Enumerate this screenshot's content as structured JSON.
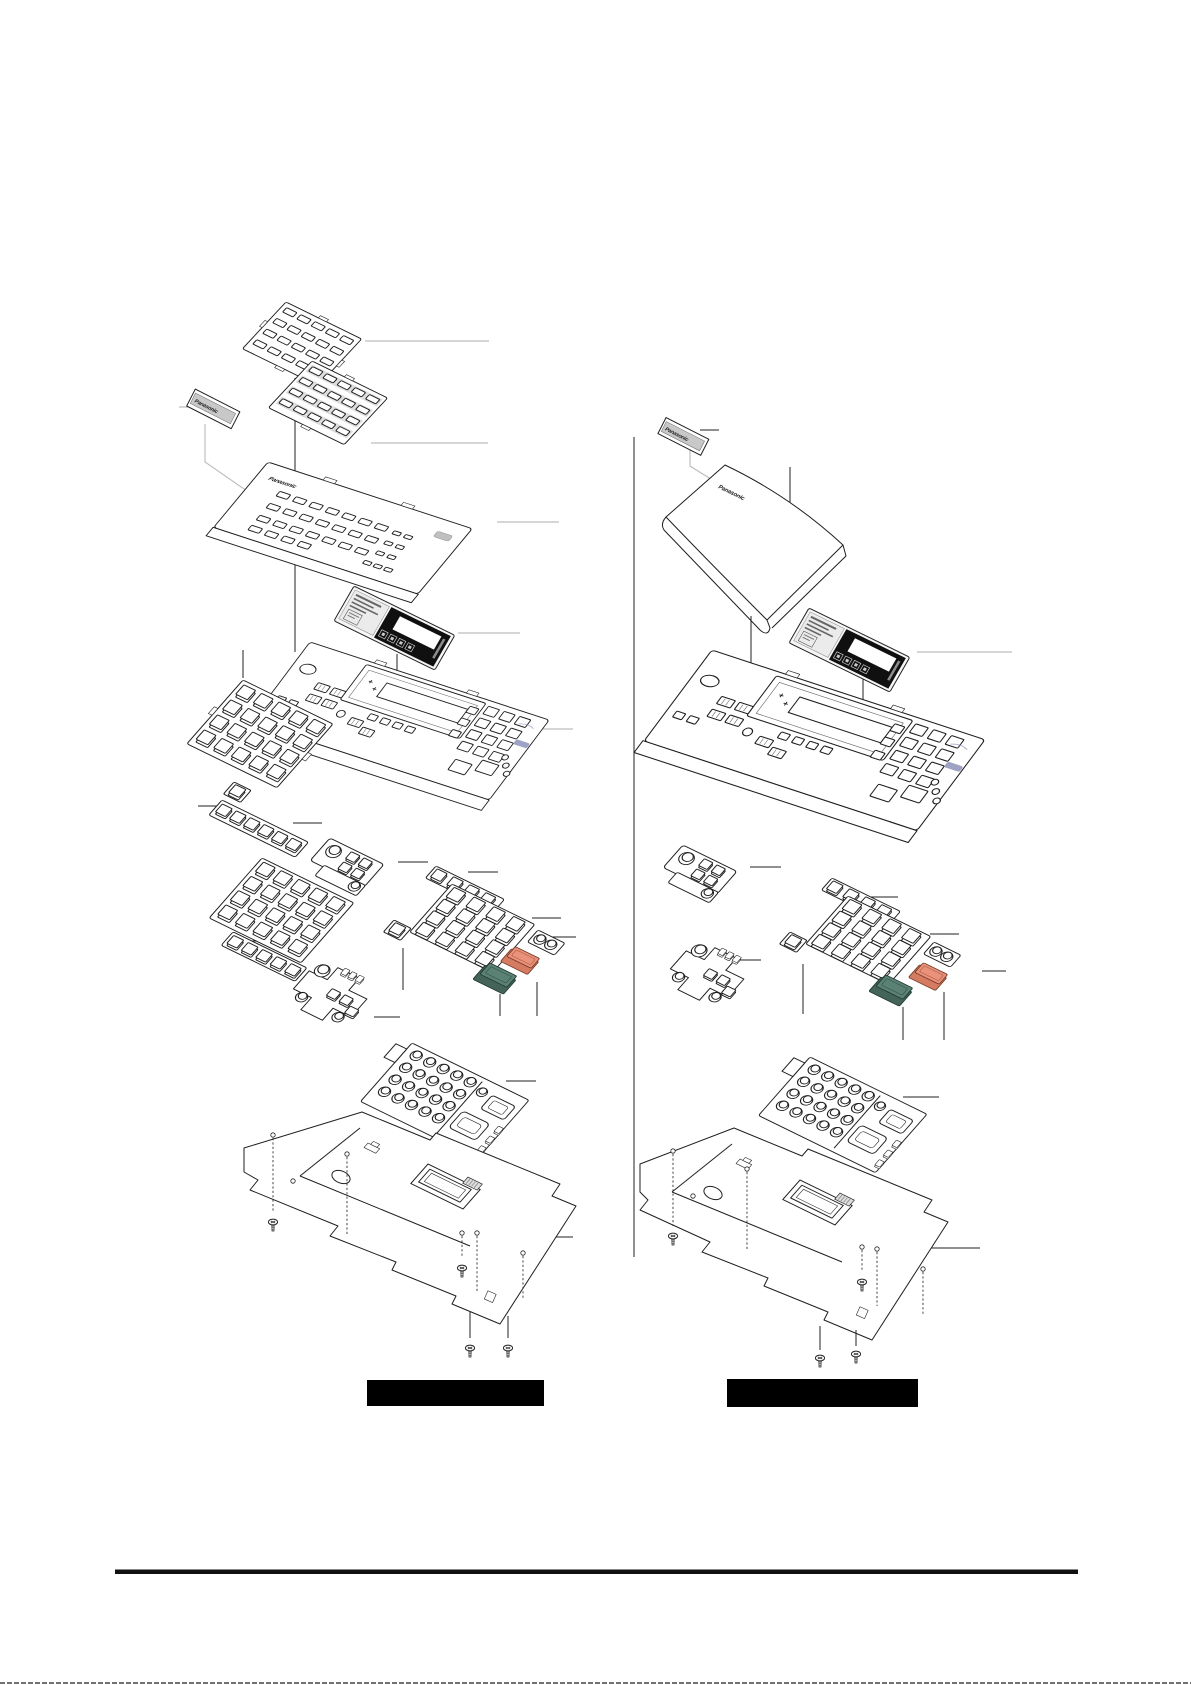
{
  "document": {
    "type": "exploded-parts-diagram-page",
    "page_background": "#ffffff"
  },
  "brand": {
    "label": "Panasonic"
  },
  "captions": {
    "left": "",
    "right": ""
  },
  "colors": {
    "line": "#1f1f1f",
    "leader_gray": "#bdbdbd",
    "shade": "#dcdcdc",
    "panel_gray": "#ebebeb",
    "label_gray": "#c8c8c8",
    "lcd": "#101010",
    "key_green": "#5a8173",
    "key_green_side": "#44645a",
    "key_salmon": "#e9917b",
    "key_salmon_side": "#d57b62",
    "logo_accent": "#8d93bc",
    "caption_bar": "#000000"
  },
  "figures": {
    "left": {
      "name": "console-with-button-panels",
      "parts": [
        "slotted-button-plate",
        "slotted-button-sheet",
        "name-label-strip",
        "upper-housing",
        "display-overlay-card",
        "main-housing",
        "dss-key-mat",
        "single-key",
        "key-strip-mat",
        "volume-key-cluster",
        "function-key-mat",
        "numeric-keypad-mat",
        "green-key",
        "salmon-key",
        "navigation-key-mat",
        "dial-keypad-mat",
        "base-plate",
        "screws"
      ]
    },
    "right": {
      "name": "console-with-blank-cover",
      "parts": [
        "name-plate",
        "blank-cover",
        "display-overlay-card",
        "main-housing",
        "volume-key-cluster",
        "navigation-key-mat",
        "numeric-keypad-mat",
        "single-key",
        "green-key",
        "salmon-key",
        "dial-keypad-mat",
        "base-plate",
        "screws"
      ]
    }
  }
}
